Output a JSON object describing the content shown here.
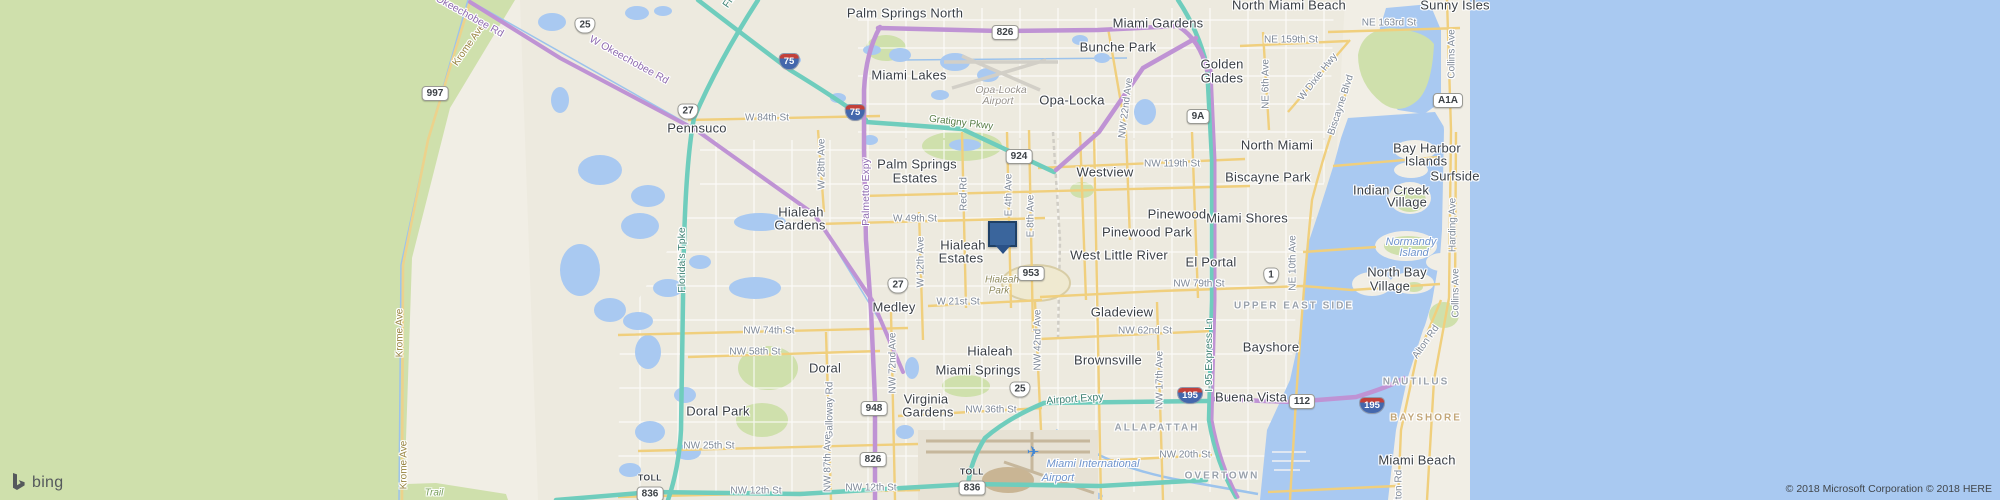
{
  "branding": {
    "logo_text": "bing",
    "copyright": "© 2018 Microsoft Corporation © 2018 HERE"
  },
  "marker": {
    "x": 988,
    "y": 221
  },
  "colors": {
    "land": "#f1eee5",
    "everglades_green": "#cfe0ac",
    "water": "#a9c9f1",
    "expressway_purple": "#bf93d4",
    "toll_teal": "#6fcdbd",
    "arterial_yellow": "#f0cf7d",
    "pin_fill": "#3a659c",
    "pin_border": "#1f4066"
  },
  "map_labels": [
    {
      "t": "Palm Springs North",
      "x": 905,
      "y": 13,
      "c": "city"
    },
    {
      "t": "Miami Gardens",
      "x": 1158,
      "y": 23,
      "c": "city"
    },
    {
      "t": "Bunche Park",
      "x": 1118,
      "y": 47,
      "c": "city"
    },
    {
      "t": "Miami Lakes",
      "x": 909,
      "y": 75,
      "c": "city"
    },
    {
      "t": "Opa-Locka",
      "x": 1072,
      "y": 100,
      "c": "city"
    },
    {
      "t": "Golden",
      "x": 1222,
      "y": 64,
      "c": "city"
    },
    {
      "t": "Glades",
      "x": 1222,
      "y": 78,
      "c": "city"
    },
    {
      "t": "North Miami Beach",
      "x": 1289,
      "y": 5,
      "c": "city"
    },
    {
      "t": "Sunny Isles",
      "x": 1455,
      "y": 5,
      "c": "city"
    },
    {
      "t": "North Miami",
      "x": 1277,
      "y": 145,
      "c": "city"
    },
    {
      "t": "Biscayne Park",
      "x": 1268,
      "y": 177,
      "c": "city"
    },
    {
      "t": "Bay Harbor",
      "x": 1427,
      "y": 148,
      "c": "city"
    },
    {
      "t": "Islands",
      "x": 1426,
      "y": 161,
      "c": "city"
    },
    {
      "t": "Surfside",
      "x": 1455,
      "y": 176,
      "c": "city"
    },
    {
      "t": "Indian Creek",
      "x": 1391,
      "y": 190,
      "c": "city"
    },
    {
      "t": "Village",
      "x": 1407,
      "y": 202,
      "c": "city"
    },
    {
      "t": "Pennsuco",
      "x": 697,
      "y": 128,
      "c": "city"
    },
    {
      "t": "Palm Springs",
      "x": 917,
      "y": 164,
      "c": "city"
    },
    {
      "t": "Estates",
      "x": 915,
      "y": 178,
      "c": "city"
    },
    {
      "t": "Westview",
      "x": 1105,
      "y": 172,
      "c": "city"
    },
    {
      "t": "Pinewood",
      "x": 1177,
      "y": 214,
      "c": "city"
    },
    {
      "t": "Miami Shores",
      "x": 1247,
      "y": 218,
      "c": "city"
    },
    {
      "t": "Pinewood Park",
      "x": 1147,
      "y": 232,
      "c": "city"
    },
    {
      "t": "West Little River",
      "x": 1119,
      "y": 255,
      "c": "city"
    },
    {
      "t": "El Portal",
      "x": 1211,
      "y": 262,
      "c": "city"
    },
    {
      "t": "Hialeah",
      "x": 801,
      "y": 212,
      "c": "city"
    },
    {
      "t": "Gardens",
      "x": 800,
      "y": 225,
      "c": "city"
    },
    {
      "t": "Hialeah",
      "x": 963,
      "y": 245,
      "c": "city"
    },
    {
      "t": "Estates",
      "x": 961,
      "y": 258,
      "c": "city"
    },
    {
      "t": "Medley",
      "x": 894,
      "y": 307,
      "c": "city"
    },
    {
      "t": "Gladeview",
      "x": 1122,
      "y": 312,
      "c": "city"
    },
    {
      "t": "Hialeah",
      "x": 990,
      "y": 351,
      "c": "city"
    },
    {
      "t": "Brownsville",
      "x": 1108,
      "y": 360,
      "c": "city"
    },
    {
      "t": "Bayshore",
      "x": 1271,
      "y": 347,
      "c": "city"
    },
    {
      "t": "Miami Springs",
      "x": 978,
      "y": 370,
      "c": "city"
    },
    {
      "t": "Doral",
      "x": 825,
      "y": 368,
      "c": "city"
    },
    {
      "t": "Virginia",
      "x": 926,
      "y": 399,
      "c": "city"
    },
    {
      "t": "Gardens",
      "x": 928,
      "y": 412,
      "c": "city"
    },
    {
      "t": "Doral Park",
      "x": 718,
      "y": 411,
      "c": "city"
    },
    {
      "t": "Buena Vista",
      "x": 1251,
      "y": 397,
      "c": "city"
    },
    {
      "t": "North Bay",
      "x": 1397,
      "y": 272,
      "c": "city"
    },
    {
      "t": "Village",
      "x": 1390,
      "y": 286,
      "c": "city"
    },
    {
      "t": "Miami Beach",
      "x": 1417,
      "y": 460,
      "c": "city"
    },
    {
      "t": "UPPER EAST SIDE",
      "x": 1294,
      "y": 306,
      "c": "hood"
    },
    {
      "t": "ALLAPATTAH",
      "x": 1157,
      "y": 428,
      "c": "hood"
    },
    {
      "t": "OVERTOWN",
      "x": 1222,
      "y": 476,
      "c": "hood"
    },
    {
      "t": "NAUTILUS",
      "x": 1416,
      "y": 382,
      "c": "hood"
    },
    {
      "t": "BAYSHORE",
      "x": 1426,
      "y": 418,
      "c": "hoodtan"
    },
    {
      "t": "Opa-Locka",
      "x": 1001,
      "y": 90,
      "c": "apt"
    },
    {
      "t": "Airport",
      "x": 998,
      "y": 101,
      "c": "apt"
    },
    {
      "t": "Hialeah",
      "x": 1002,
      "y": 280,
      "c": "park"
    },
    {
      "t": "Park",
      "x": 999,
      "y": 291,
      "c": "park"
    },
    {
      "t": "Normandy",
      "x": 1411,
      "y": 242,
      "c": "aqua"
    },
    {
      "t": "Island",
      "x": 1414,
      "y": 253,
      "c": "aqua"
    },
    {
      "t": "Miami International",
      "x": 1093,
      "y": 464,
      "c": "aqua"
    },
    {
      "t": "Airport",
      "x": 1058,
      "y": 478,
      "c": "aqua"
    },
    {
      "t": "Trail",
      "x": 434,
      "y": 493,
      "c": "trail"
    },
    {
      "t": "✈",
      "x": 1033,
      "y": 452,
      "c": "plane"
    },
    {
      "t": "Krome Ave",
      "x": 469,
      "y": 45,
      "c": "rdo",
      "r": -55
    },
    {
      "t": "Krome Ave",
      "x": 400,
      "y": 333,
      "c": "rdo",
      "r": -90
    },
    {
      "t": "Krome Ave",
      "x": 404,
      "y": 465,
      "c": "rdo",
      "r": -90
    },
    {
      "t": "W Okeechobee Rd",
      "x": 464,
      "y": 13,
      "c": "rdp",
      "r": 29
    },
    {
      "t": "W Okeechobee Rd",
      "x": 629,
      "y": 60,
      "c": "rdp",
      "r": 29
    },
    {
      "t": "Florida's Tpke",
      "x": 744,
      "y": -20,
      "c": "rdt",
      "r": -55
    },
    {
      "t": "Florida's Tpke",
      "x": 682,
      "y": 260,
      "c": "rdt",
      "r": -90
    },
    {
      "t": "W 84th St",
      "x": 767,
      "y": 118,
      "c": "st"
    },
    {
      "t": "W 28th Ave",
      "x": 822,
      "y": 164,
      "c": "st",
      "r": -90
    },
    {
      "t": "Palmetto Expy",
      "x": 866,
      "y": 192,
      "c": "rdp",
      "r": -90
    },
    {
      "t": "Gratigny Pkwy",
      "x": 961,
      "y": 123,
      "c": "rdg",
      "r": 7
    },
    {
      "t": "NE 159th St",
      "x": 1291,
      "y": 40,
      "c": "st"
    },
    {
      "t": "NE 163rd St",
      "x": 1389,
      "y": 23,
      "c": "st"
    },
    {
      "t": "NE 6th Ave",
      "x": 1266,
      "y": 84,
      "c": "st",
      "r": -90
    },
    {
      "t": "W Dixie Hwy",
      "x": 1318,
      "y": 77,
      "c": "st",
      "r": -52
    },
    {
      "t": "Biscayne Blvd",
      "x": 1341,
      "y": 105,
      "c": "st",
      "r": -72
    },
    {
      "t": "NW 22nd Ave",
      "x": 1126,
      "y": 108,
      "c": "st",
      "r": -83
    },
    {
      "t": "NW 119th St",
      "x": 1172,
      "y": 164,
      "c": "st"
    },
    {
      "t": "W 49th St",
      "x": 915,
      "y": 219,
      "c": "st"
    },
    {
      "t": "Red Rd",
      "x": 964,
      "y": 194,
      "c": "st",
      "r": -90
    },
    {
      "t": "E 4th Ave",
      "x": 1009,
      "y": 195,
      "c": "st",
      "r": -90
    },
    {
      "t": "E 8th Ave",
      "x": 1031,
      "y": 216,
      "c": "st",
      "r": -90
    },
    {
      "t": "W 12th Ave",
      "x": 921,
      "y": 262,
      "c": "st",
      "r": -90
    },
    {
      "t": "W 21st St",
      "x": 958,
      "y": 302,
      "c": "st"
    },
    {
      "t": "NW 74th St",
      "x": 769,
      "y": 331,
      "c": "st"
    },
    {
      "t": "NW 79th St",
      "x": 1199,
      "y": 284,
      "c": "st"
    },
    {
      "t": "NW 62nd St",
      "x": 1145,
      "y": 331,
      "c": "st"
    },
    {
      "t": "NW 58th St",
      "x": 755,
      "y": 352,
      "c": "st"
    },
    {
      "t": "NW 72nd Ave",
      "x": 893,
      "y": 363,
      "c": "st",
      "r": -90
    },
    {
      "t": "NW 42nd Ave",
      "x": 1038,
      "y": 340,
      "c": "st",
      "r": -90
    },
    {
      "t": "NW 17th Ave",
      "x": 1160,
      "y": 380,
      "c": "st",
      "r": -90
    },
    {
      "t": "I-95 Express Ln",
      "x": 1209,
      "y": 355,
      "c": "rdt",
      "r": -90
    },
    {
      "t": "Airport Expy",
      "x": 1075,
      "y": 399,
      "c": "rdt",
      "r": -4
    },
    {
      "t": "NW 36th St",
      "x": 991,
      "y": 410,
      "c": "st"
    },
    {
      "t": "NW 25th St",
      "x": 709,
      "y": 446,
      "c": "st"
    },
    {
      "t": "NW 20th St",
      "x": 1185,
      "y": 455,
      "c": "st"
    },
    {
      "t": "NW 12th St",
      "x": 756,
      "y": 491,
      "c": "st"
    },
    {
      "t": "NW 12th St",
      "x": 871,
      "y": 488,
      "c": "st"
    },
    {
      "t": "Galloway Rd",
      "x": 830,
      "y": 410,
      "c": "st",
      "r": -90
    },
    {
      "t": "NW 87th Ave",
      "x": 828,
      "y": 463,
      "c": "st",
      "r": -90
    },
    {
      "t": "Harding Ave",
      "x": 1453,
      "y": 225,
      "c": "st",
      "r": -90
    },
    {
      "t": "Alton Rd",
      "x": 1426,
      "y": 342,
      "c": "st",
      "r": -55
    },
    {
      "t": "Alton Rd",
      "x": 1399,
      "y": 489,
      "c": "st",
      "r": -90
    },
    {
      "t": "Collins Ave",
      "x": 1452,
      "y": 54,
      "c": "st",
      "r": -90
    },
    {
      "t": "Collins Ave",
      "x": 1456,
      "y": 293,
      "c": "st",
      "r": -90
    },
    {
      "t": "NE 10th Ave",
      "x": 1293,
      "y": 263,
      "c": "st",
      "r": -90
    }
  ],
  "shields": [
    {
      "k": "us",
      "t": "27",
      "x": 688,
      "y": 110
    },
    {
      "k": "us",
      "t": "27",
      "x": 898,
      "y": 284
    },
    {
      "k": "us",
      "t": "25",
      "x": 585,
      "y": 24
    },
    {
      "k": "us",
      "t": "25",
      "x": 1020,
      "y": 388
    },
    {
      "k": "us",
      "t": "1",
      "x": 1271,
      "y": 274
    },
    {
      "k": "int",
      "t": "75",
      "x": 789,
      "y": 60
    },
    {
      "k": "int",
      "t": "75",
      "x": 855,
      "y": 111
    },
    {
      "k": "int",
      "t": "195",
      "x": 1190,
      "y": 394
    },
    {
      "k": "int",
      "t": "195",
      "x": 1372,
      "y": 404
    },
    {
      "k": "st",
      "t": "997",
      "x": 435,
      "y": 92
    },
    {
      "k": "st",
      "t": "826",
      "x": 1005,
      "y": 31
    },
    {
      "k": "st",
      "t": "826",
      "x": 873,
      "y": 458
    },
    {
      "k": "st",
      "t": "9A",
      "x": 1198,
      "y": 115
    },
    {
      "k": "st",
      "t": "924",
      "x": 1019,
      "y": 155
    },
    {
      "k": "st",
      "t": "953",
      "x": 1031,
      "y": 272
    },
    {
      "k": "st",
      "t": "948",
      "x": 874,
      "y": 407
    },
    {
      "k": "st",
      "t": "112",
      "x": 1302,
      "y": 400
    },
    {
      "k": "st",
      "t": "A1A",
      "x": 1448,
      "y": 99
    },
    {
      "k": "toll",
      "t": "836",
      "x": 650,
      "y": 487,
      "p": "TOLL"
    },
    {
      "k": "toll",
      "t": "836",
      "x": 972,
      "y": 481,
      "p": "TOLL"
    }
  ]
}
